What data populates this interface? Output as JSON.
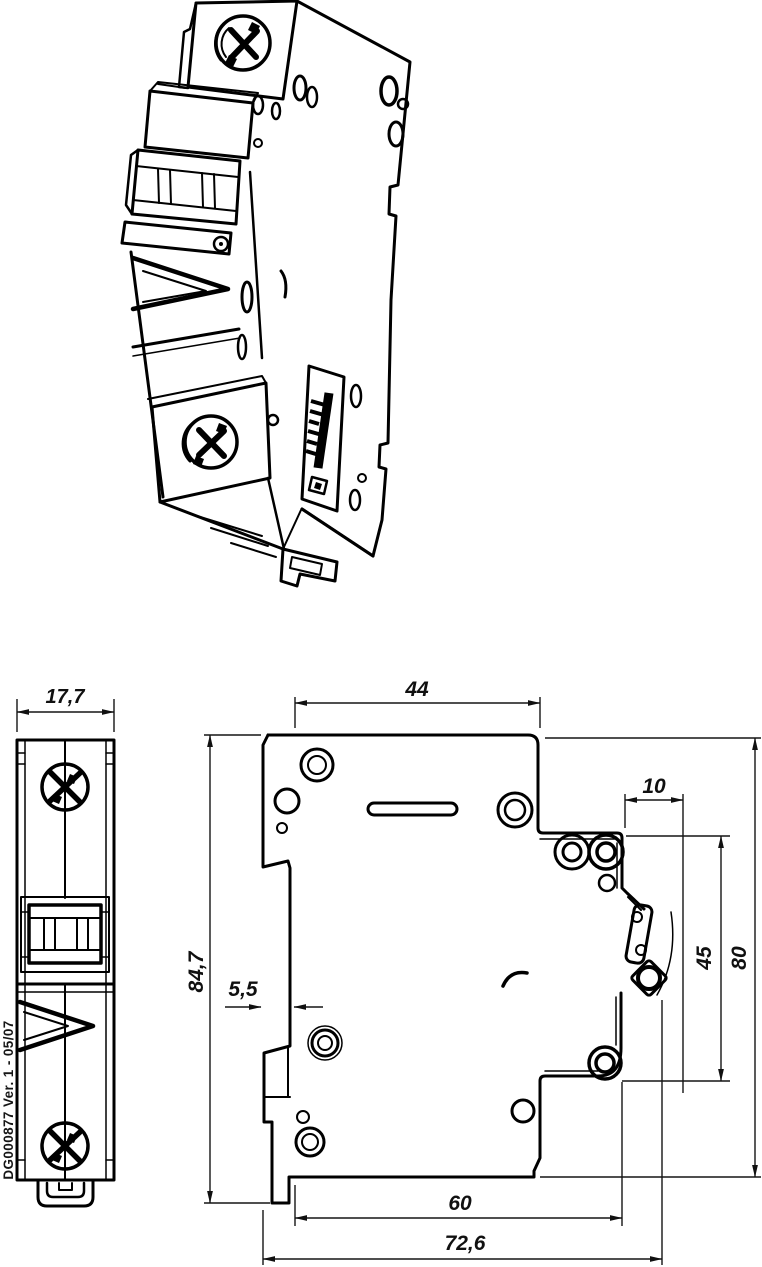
{
  "drawing": {
    "type": "technical-drawing",
    "subject": "single-pole miniature circuit breaker",
    "views": {
      "isometric": "perspective line drawing, top",
      "front": "front view, bottom left",
      "side": "side view, bottom right"
    }
  },
  "dimensions": {
    "front_width": "17,7",
    "top_width": "44",
    "handle_offset": "10",
    "total_height": "84,7",
    "rail_depth": "5,5",
    "right_inner_height": "45",
    "body_height": "80",
    "bottom_width": "60",
    "overall_depth": "72,6"
  },
  "annotations": {
    "doc_reference": "DG000877 Ver. 1 - 05/07"
  },
  "colors": {
    "line": "#000000",
    "background": "#ffffff"
  }
}
